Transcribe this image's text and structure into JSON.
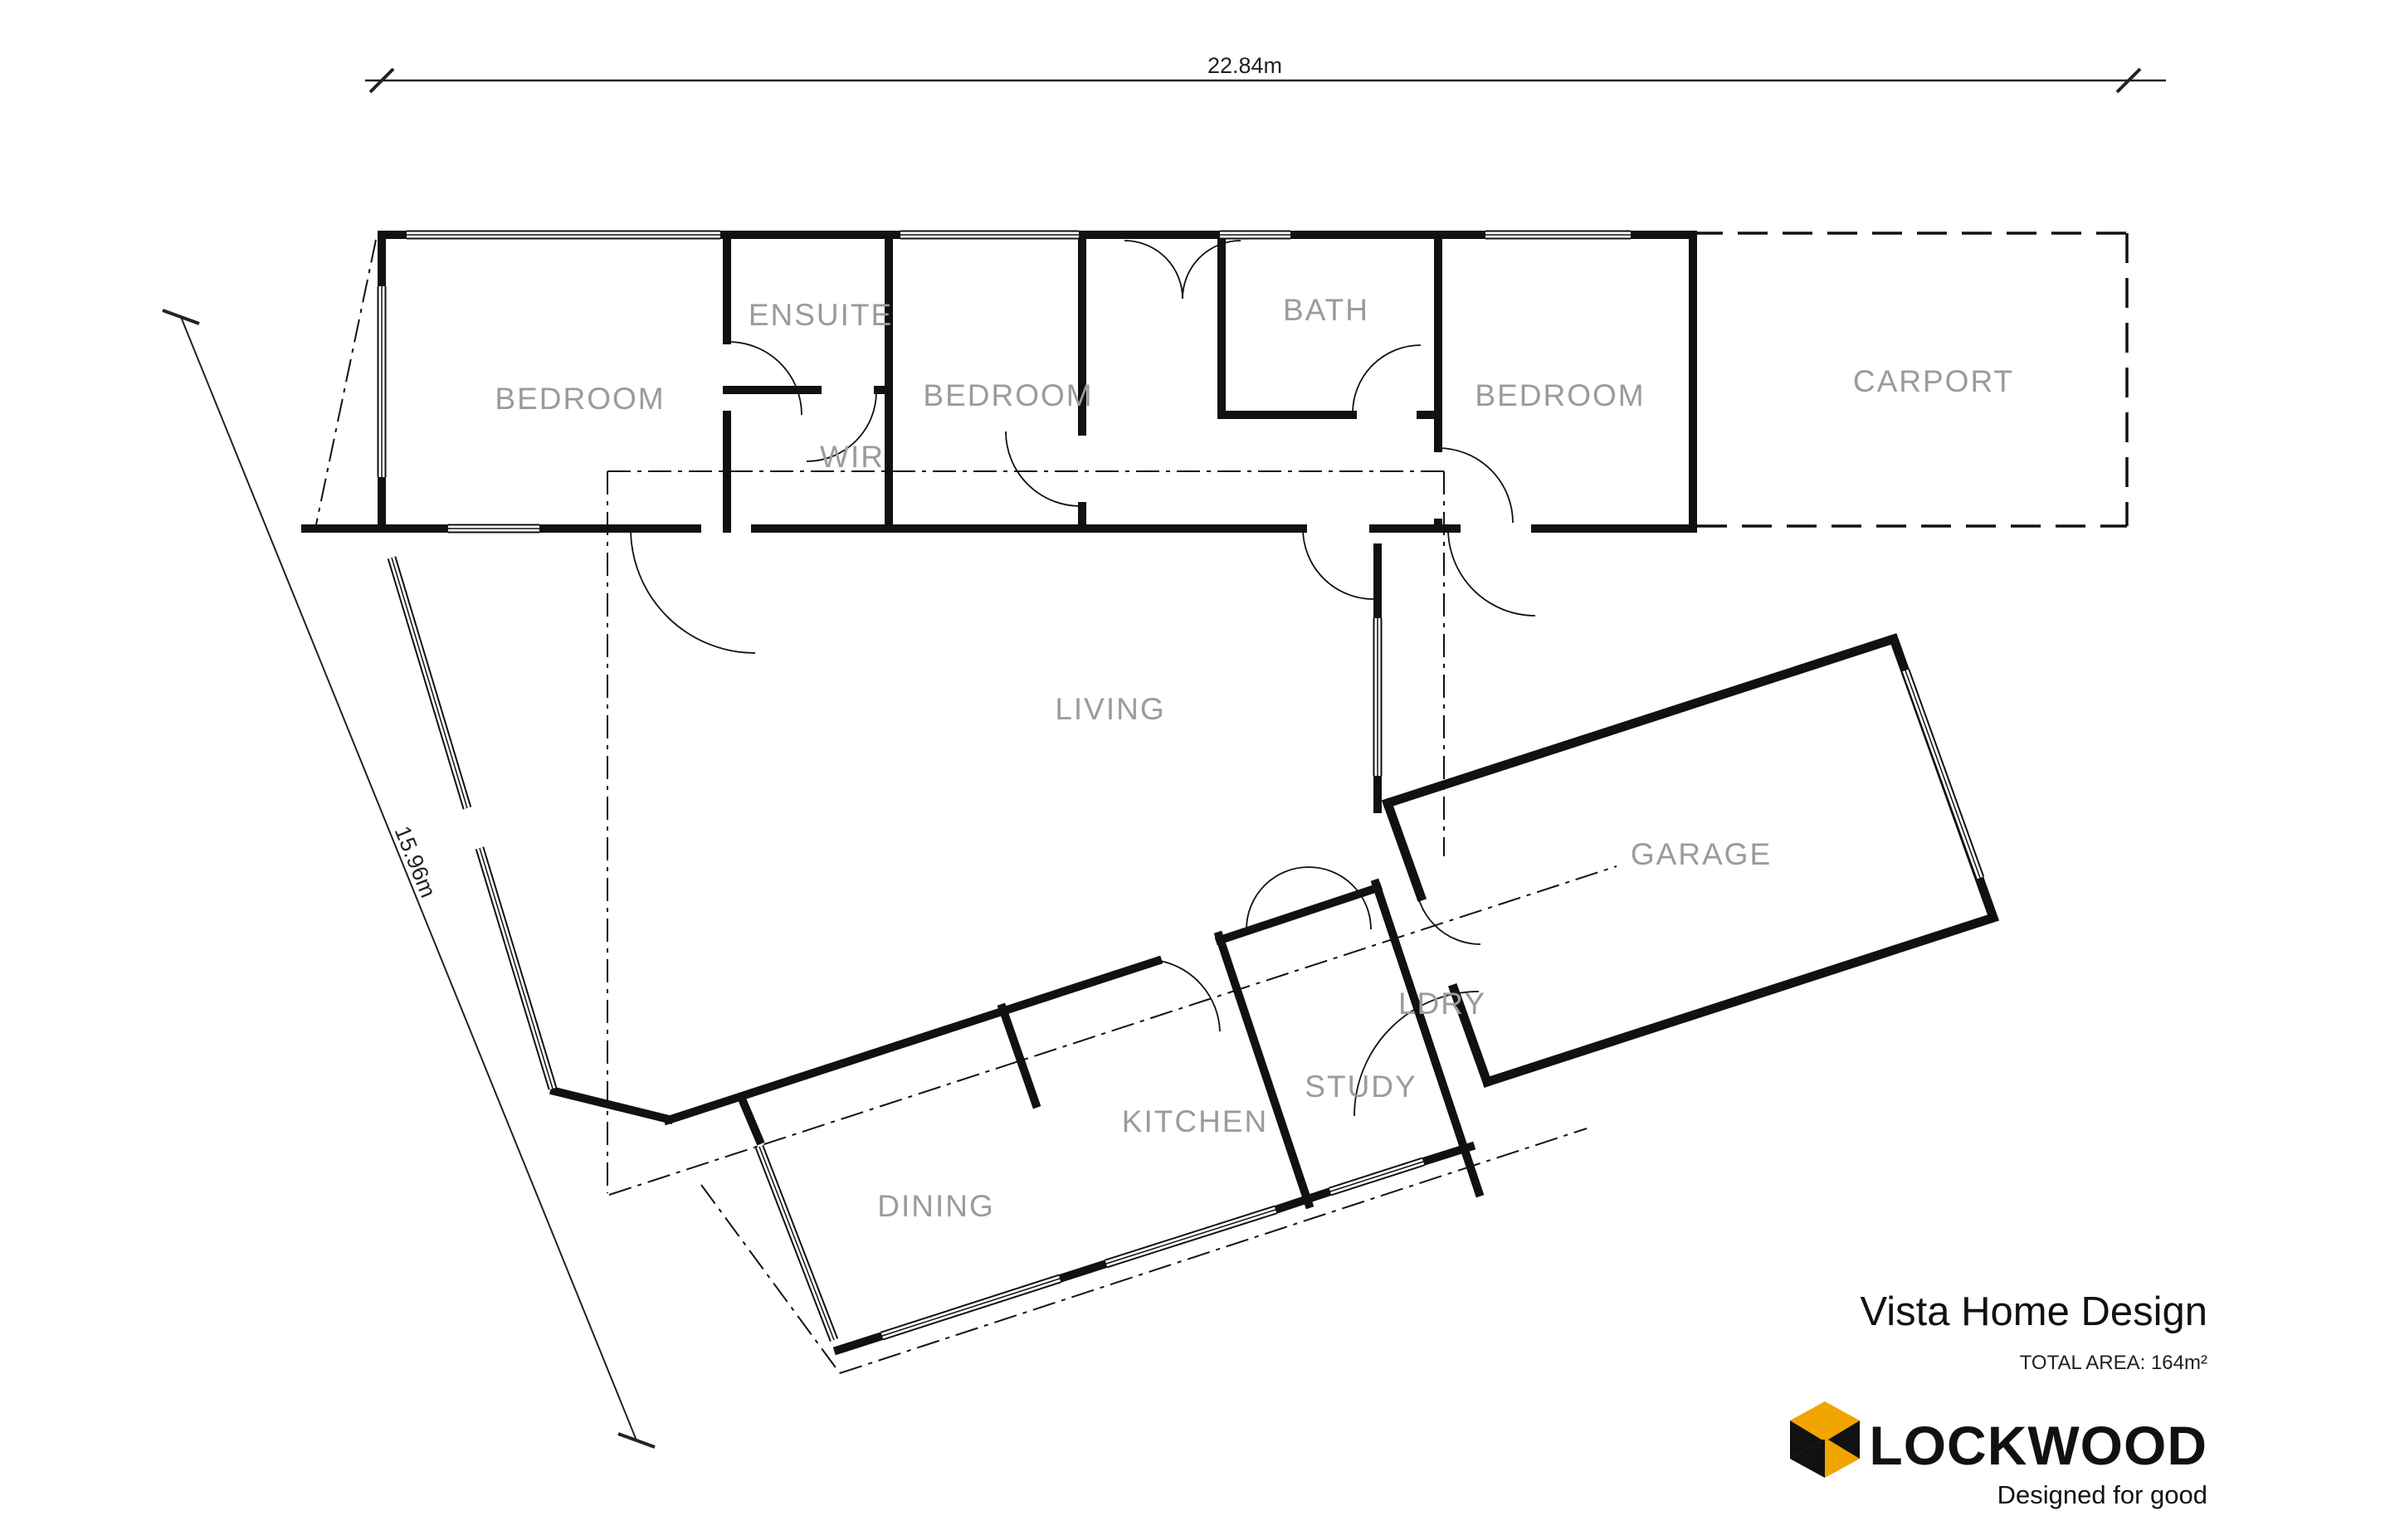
{
  "plan": {
    "dimensions": {
      "width_label": "22.84m",
      "side_label": "15.96m"
    },
    "rooms": {
      "bedroom_left": "BEDROOM",
      "ensuite": "ENSUITE",
      "wir": "WIR",
      "bedroom_mid": "BEDROOM",
      "bath": "BATH",
      "bedroom_right": "BEDROOM",
      "carport": "CARPORT",
      "living": "LIVING",
      "garage": "GARAGE",
      "ldry": "LDRY",
      "study": "STUDY",
      "kitchen": "KITCHEN",
      "dining": "DINING"
    }
  },
  "title_block": {
    "title": "Vista Home Design",
    "total_area": "TOTAL AREA: 164m²",
    "brand": "LOCKWOOD",
    "tagline": "Designed for good"
  },
  "colors": {
    "accent": "#F0A500",
    "label_gray": "#9B9B9B",
    "line": "#111111"
  }
}
